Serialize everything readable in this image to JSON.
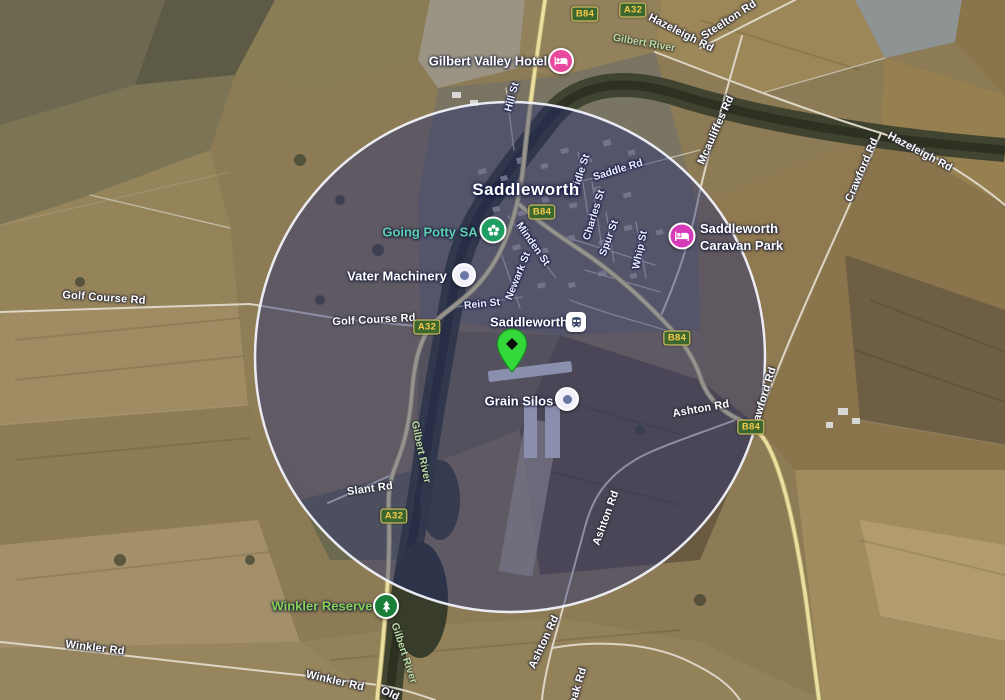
{
  "town": "Saddleworth",
  "pois": {
    "gilbert_valley_hotel": "Gilbert Valley Hotel",
    "going_potty": "Going Potty SA",
    "vater_machinery": "Vater Machinery",
    "station": "Saddleworth",
    "caravan_park_line1": "Saddleworth",
    "caravan_park_line2": "Caravan Park",
    "grain_silos": "Grain Silos",
    "winkler_reserve": "Winkler Reserve"
  },
  "routes": {
    "b84": "B84",
    "a32": "A32"
  },
  "roads": {
    "hazeleigh": "Hazeleigh Rd",
    "steelton": "Steelton Rd",
    "crawford": "Crawford Rd",
    "mcauliffes": "Mcauliffes Rd",
    "golf_course": "Golf Course Rd",
    "winkler": "Winkler Rd",
    "slant": "Slant Rd",
    "ashton": "Ashton Rd",
    "hill_st": "Hill St",
    "saddle_rd": "Saddle Rd",
    "bridle_st": "Bridle St",
    "charles_st": "Charles St",
    "spur_st": "Spur St",
    "whip_st": "Whip St",
    "minden_st": "Minden St",
    "newark_st": "Newark St",
    "rein_st": "Rein St",
    "old_partial": "Old",
    "oak_partial": "oak Rd"
  },
  "rivers": {
    "gilbert": "Gilbert River"
  },
  "colors": {
    "overlay_fill": "#1e2a78",
    "overlay_stroke": "#eef0f8",
    "badge_bg": "#3b672f",
    "badge_text": "#f5ca4c",
    "hotel_pink": "#e8489d",
    "caravan_magenta": "#d63ab8",
    "going_potty_green": "#1e9e63",
    "going_potty_text": "#5ecfae",
    "reserve_green": "#188038",
    "reserve_text": "#86d254",
    "pin_green": "#35d83a",
    "highway_fill": "#eadf9f"
  }
}
